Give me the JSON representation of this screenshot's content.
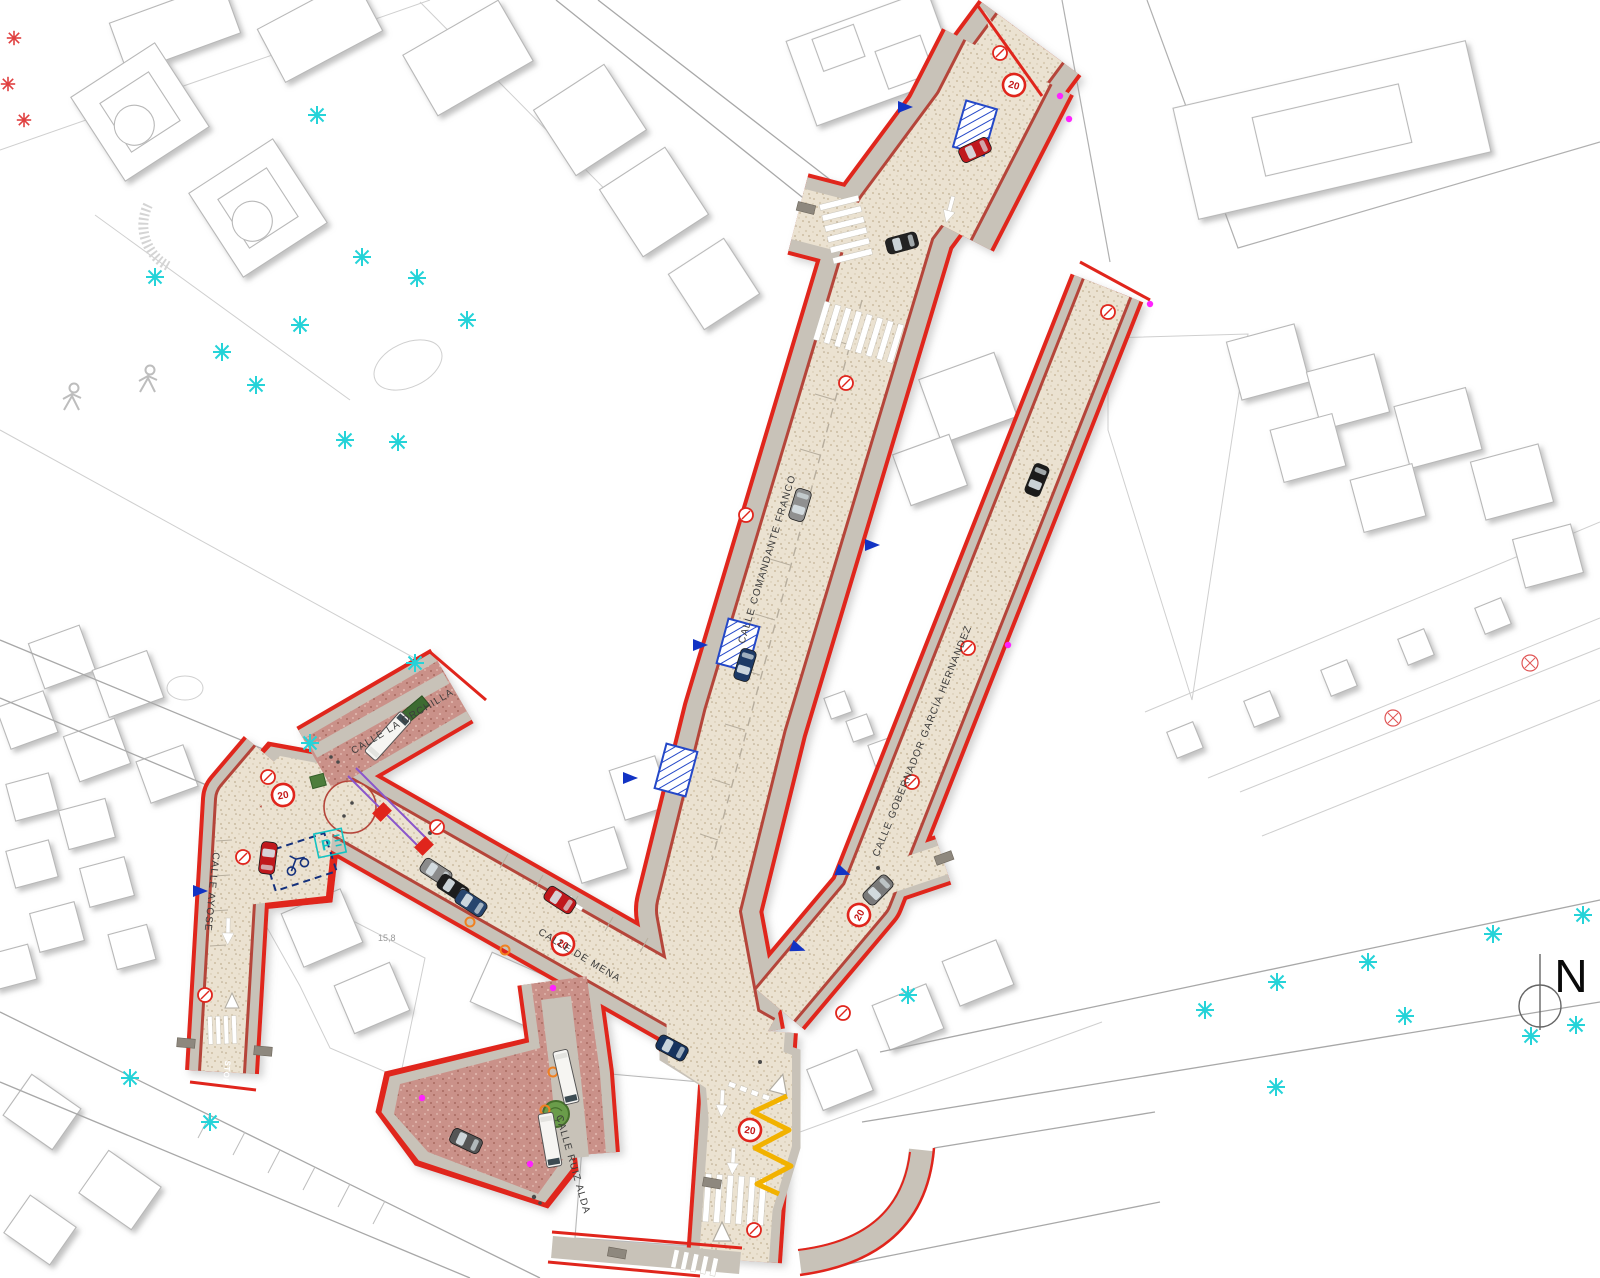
{
  "map": {
    "streets": {
      "comandante_franco": "CALLE COMANDANTE FRANCO",
      "gobernador_garcia_hernandez": "CALLE GOBERNADOR GARCÍA HERNANDEZ",
      "ayose": "CALLE AYOSE",
      "la_orchilla": "CALLE LA ORCHILLA",
      "de_mena": "CALLE DE MENA",
      "ruiz_alda": "CALLE RUIZ ALDA"
    },
    "signs": {
      "speed_limit": "20",
      "stop": "STOP",
      "parking": "P"
    },
    "north_label": "N",
    "measurement_label": "15,8",
    "colors": {
      "boundary_red": "#e0251c",
      "inner_red": "#b5453a",
      "sidewalk_gray": "#c8c2b8",
      "paving_beige": "#ebe2d1",
      "paving_pink": "#ca9189",
      "tree_cyan": "#25d3d8",
      "parking_blue": "#1540c8",
      "zigzag_yellow": "#f2b200",
      "works_purple": "#8a55cc",
      "dot_magenta": "#ff22ff"
    }
  }
}
